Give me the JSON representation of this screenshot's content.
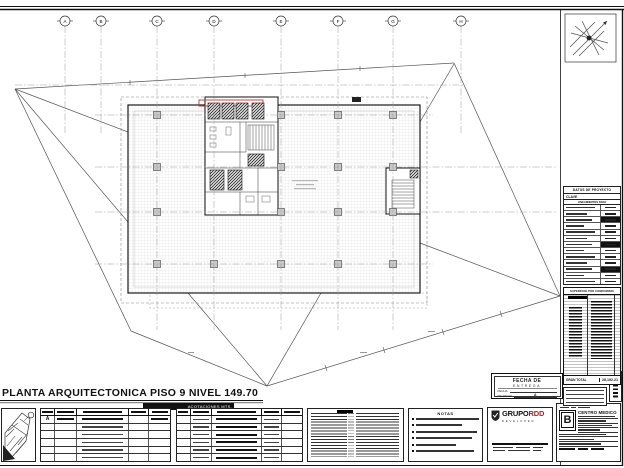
{
  "sheet": {
    "title": "PLANTA ARQUITECTONICA PISO 9 NIVEL 149.70",
    "units_label": "ACOTACIONES MTS."
  },
  "grid": {
    "letters": [
      "A",
      "B",
      "C",
      "D",
      "E",
      "F",
      "G",
      "H"
    ]
  },
  "right_panel": {
    "datos_title": "DATOS DE PROYECTO",
    "clave_label": "CLAVE",
    "lineamientos_label": "LINEAMIENTOS PARA",
    "datos_row_count": 13,
    "superficie_title": "SUPERFICIE POR CONDOMINIO",
    "gran_total_label": "GRAN TOTAL",
    "gran_total_value": "28,192.21",
    "note_line_count": 4
  },
  "revisions": {
    "table1_row_letter": "A",
    "table1_extra_rows": 5,
    "table2_rows": 6
  },
  "notes": {
    "header": "NOTAS",
    "line_count": 6
  },
  "delivery": {
    "title_line1": "FECHA DE",
    "title_line2": "ENTREGA",
    "fecha_label": "FECHA",
    "revision_label": "REVISION",
    "revision_value": "A"
  },
  "title_block": {
    "company_name": "GRUPO",
    "company_accent": "RDD",
    "company_tagline": "DEVELOPER",
    "project_name": "CENTRO MEDICO",
    "sheet_revision": "B"
  }
}
